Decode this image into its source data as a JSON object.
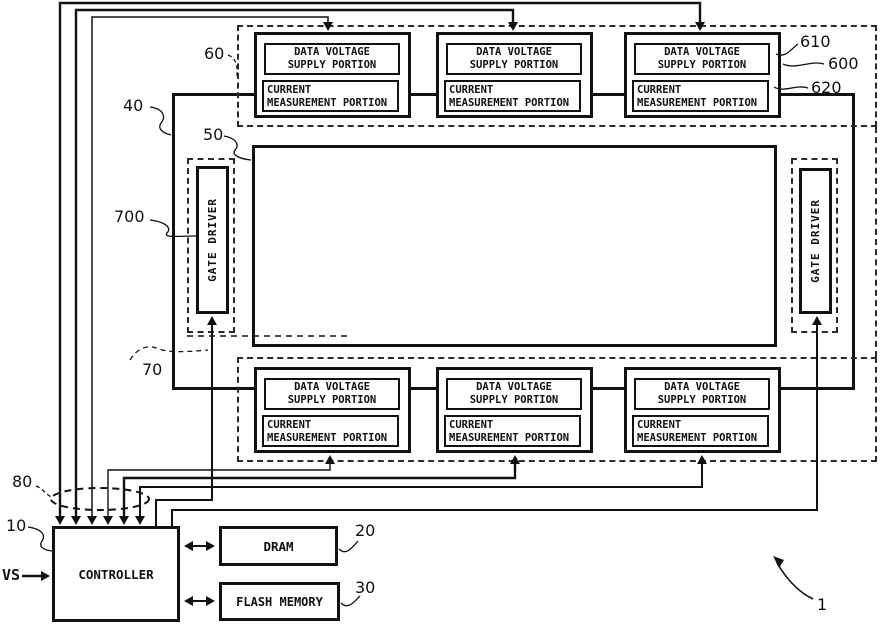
{
  "blocks": {
    "data_voltage_supply_line1": "DATA VOLTAGE",
    "data_voltage_supply_line2": "SUPPLY PORTION",
    "current_measurement_line1": "CURRENT",
    "current_measurement_line2": "MEASUREMENT PORTION",
    "gate_driver": "GATE DRIVER",
    "controller": "CONTROLLER",
    "dram": "DRAM",
    "flash_memory": "FLASH MEMORY"
  },
  "signals": {
    "vs": "VS"
  },
  "reference_numerals": {
    "top_driver_row": "60",
    "display_panel": "40",
    "display_area": "50",
    "gate_driver": "700",
    "gate_driver_region": "70",
    "control_bus": "80",
    "controller": "10",
    "dram": "20",
    "flash_memory": "30",
    "data_voltage_supply_portion": "610",
    "driver_block": "600",
    "current_measurement_portion": "620",
    "device": "1"
  },
  "colors": {
    "line": "#111111",
    "background": "#ffffff"
  }
}
